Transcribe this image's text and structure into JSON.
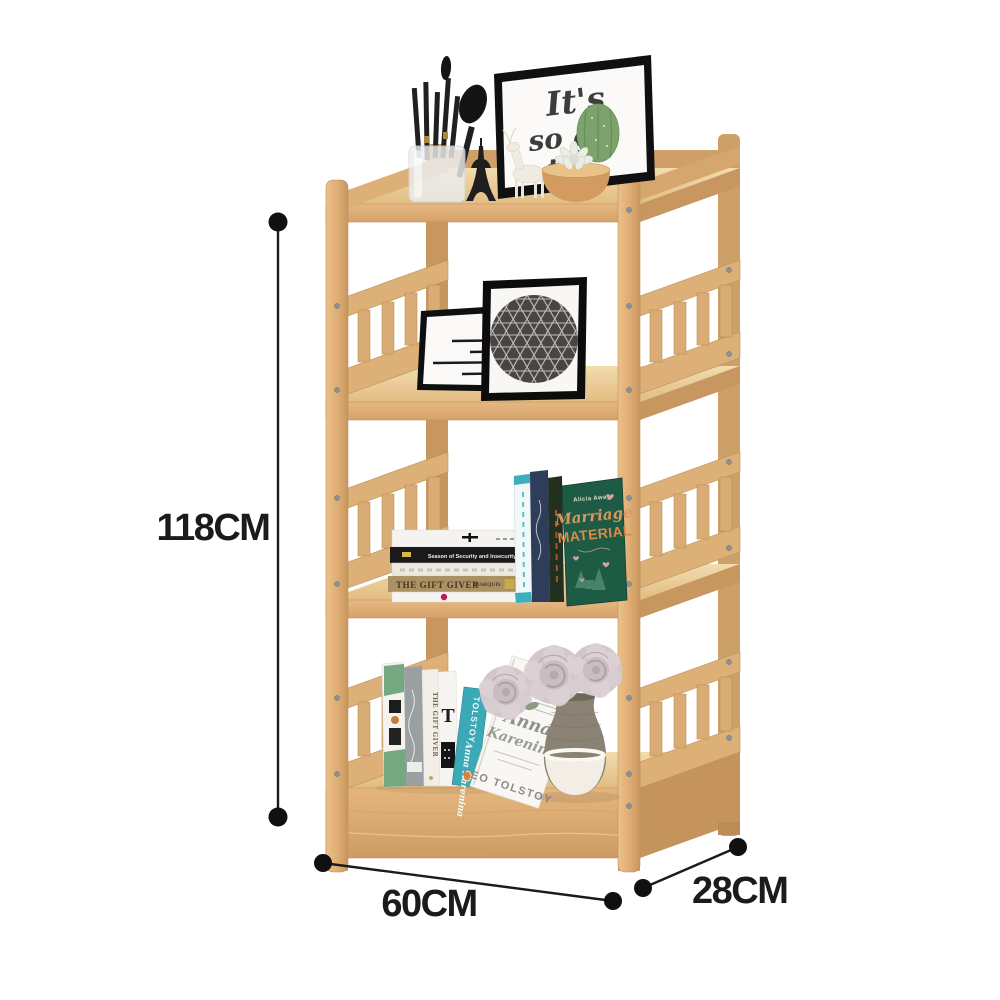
{
  "image": {
    "description": "Wooden four-tier slatted storage shelf product photo with dimension annotations",
    "background": "#ffffff"
  },
  "dimensions": {
    "height": "118CM",
    "width": "60CM",
    "depth": "28CM",
    "ink": "#1b1b1b"
  },
  "palette": {
    "wood_front": "#E0B077",
    "wood_top": "#EDD2A0",
    "wood_side": "#C8965F",
    "teal_book": "#3BA9B6",
    "navy_book": "#2E3D59",
    "green_cover": "#1D5B45",
    "green_cover_title": "#DB8A49",
    "tan_spine": "#AC9164",
    "vase_grey": "#8A8273",
    "rose": "#D3C7CB",
    "cactus": "#7CA36B"
  },
  "top_shelf": {
    "art_print": {
      "line1": "It's",
      "line2": "so go",
      "line3": "t"
    }
  },
  "shelf3": {
    "stack": {
      "security_spine": "Season of Security and Insecurity",
      "gift_giver_spine": "THE GIFT GIVER",
      "marquis": "MARQUIS"
    },
    "green_book": {
      "author": "Alicia Away",
      "title_script": "Marriage",
      "title_caps": "MATERIAL"
    }
  },
  "shelf4": {
    "gift_giver_spine": "THE GIFT GIVER",
    "t_mark": "T",
    "tolstoy_spine": "TOLSTOY",
    "anna_spine": "Anna Karenina",
    "big_book": {
      "script_line1": "Anna",
      "script_line2": "Karenina",
      "author": "LEO TOLSTOY"
    }
  }
}
